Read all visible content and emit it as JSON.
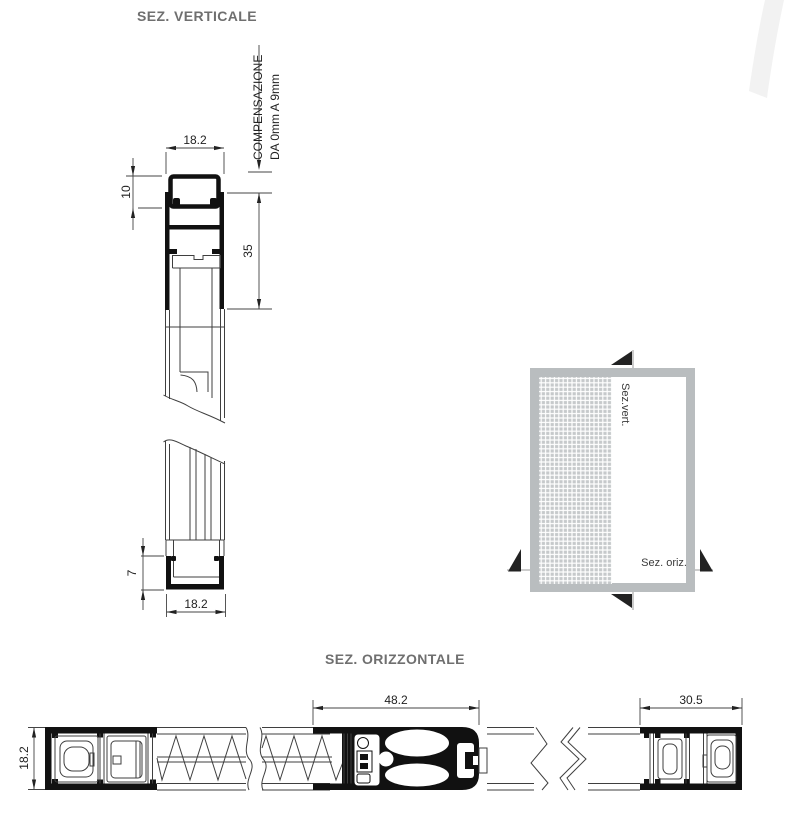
{
  "titles": {
    "vertical_section": "SEZ. VERTICALE",
    "horizontal_section": "SEZ. ORIZZONTALE"
  },
  "vertical_section": {
    "compensation_note": {
      "line1": "COMPENSAZIONE",
      "line2": "DA 0mm A 9mm"
    },
    "dims": {
      "top_width": "18.2",
      "cassette_height": "10",
      "frame_depth": "35",
      "bottom_channel_height": "7",
      "bottom_width": "18.2"
    }
  },
  "overview_diagram": {
    "vertical_cut_label": "Sez.vert.",
    "horizontal_cut_label": "Sez. oriz."
  },
  "horizontal_section": {
    "dims": {
      "profile_height": "18.2",
      "handle_bar_width": "48.2",
      "side_profile_width": "30.5"
    }
  },
  "colors": {
    "background": "#ffffff",
    "drawing_line": "#111111",
    "thin_line": "#3f3f3f",
    "dim_text": "#222222",
    "title_text": "#6f6f6f",
    "frame_gray": "#b9bdbf",
    "mesh_gray": "#c6c9cb",
    "watermark": "#f2f2f2"
  }
}
